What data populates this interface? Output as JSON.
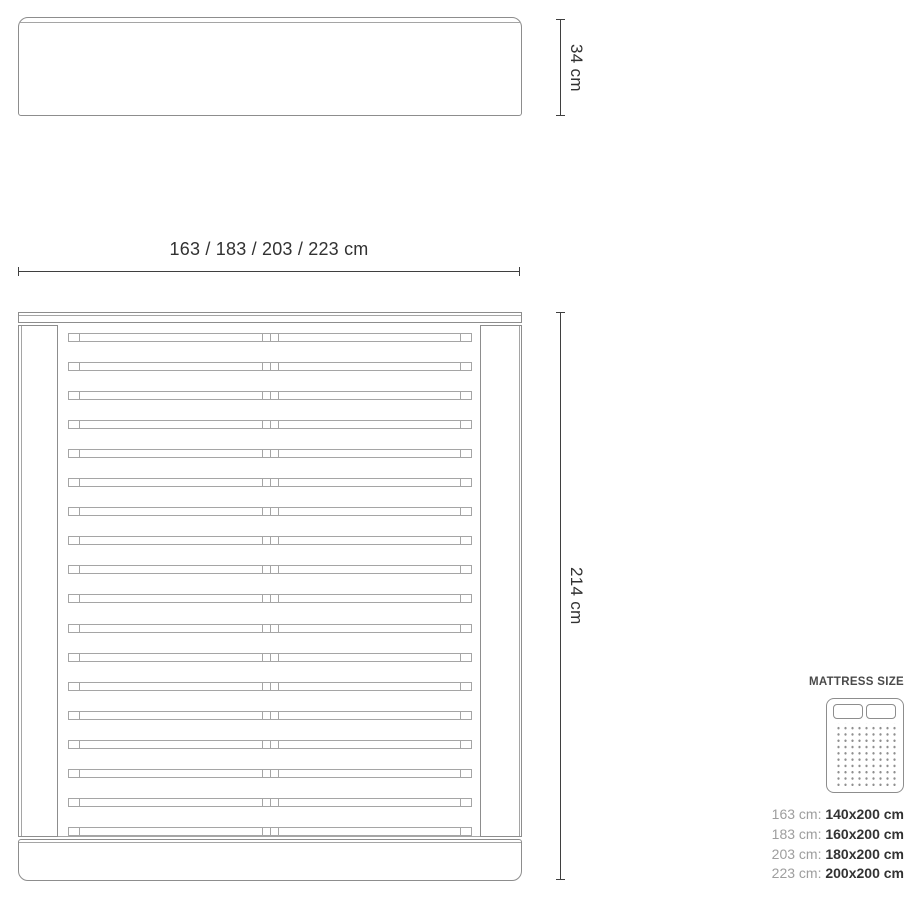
{
  "diagram": {
    "headboard_height_label": "34 cm",
    "width_label": "163 / 183 / 203 / 223 cm",
    "length_label": "214 cm",
    "slat_count": 18
  },
  "legend": {
    "title": "MATTRESS SIZE",
    "icon": "double-mattress-icon",
    "rows": [
      {
        "frame": "163 cm:",
        "mattress": "140x200 cm"
      },
      {
        "frame": "183 cm:",
        "mattress": "160x200 cm"
      },
      {
        "frame": "203 cm:",
        "mattress": "180x200 cm"
      },
      {
        "frame": "223 cm:",
        "mattress": "200x200 cm"
      }
    ]
  },
  "colors": {
    "line": "#8d8d8d",
    "line-light": "#a5a5a5",
    "dim": "#3f3f3f",
    "text": "#323232",
    "muted": "#9e9e9e"
  }
}
